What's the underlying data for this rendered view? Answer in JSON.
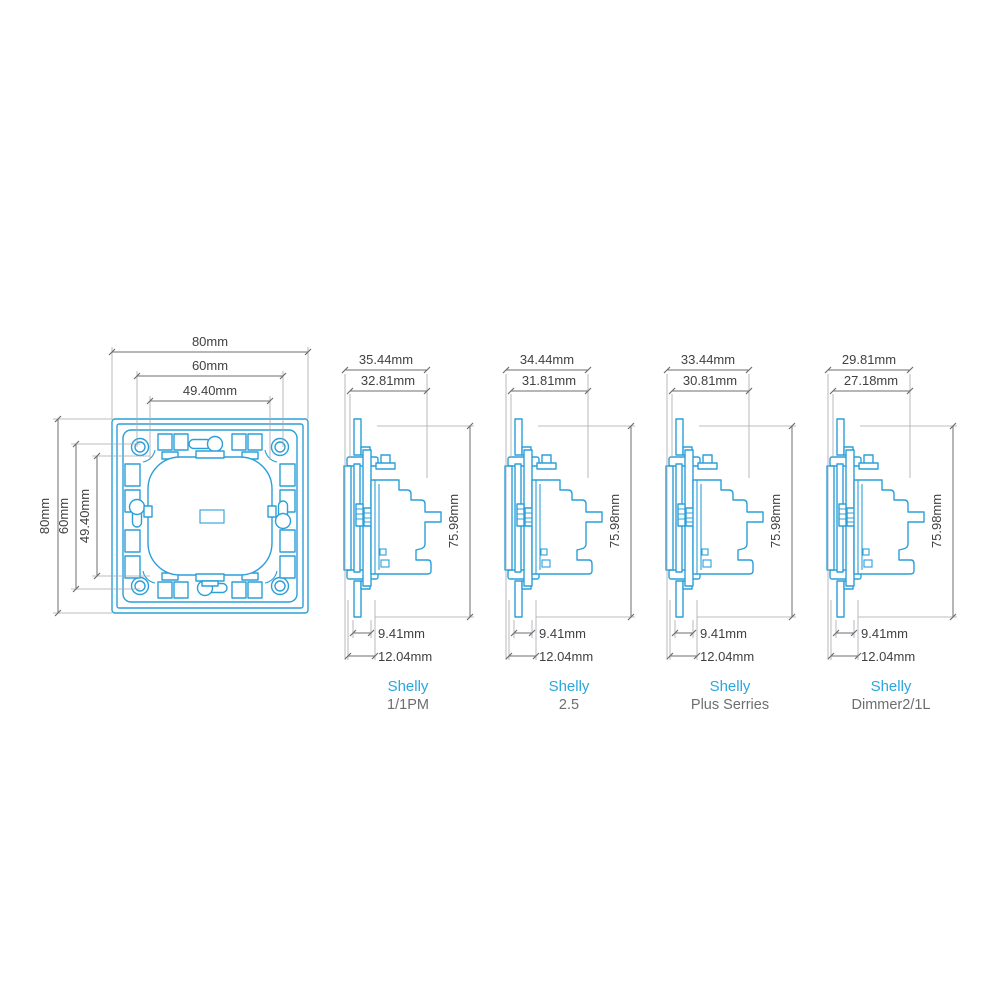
{
  "colors": {
    "device_line": "#2B9FD8",
    "brand_text": "#2AA7DF",
    "model_text": "#6D6E71",
    "dim_line": "#6D6E71",
    "dim_ext": "#A7A9AC",
    "dim_text": "#414042"
  },
  "front_view": {
    "top_dims": [
      {
        "label": "80mm"
      },
      {
        "label": "60mm"
      },
      {
        "label": "49.40mm"
      }
    ],
    "left_dims": [
      {
        "label": "80mm"
      },
      {
        "label": "60mm"
      },
      {
        "label": "49.40mm"
      }
    ]
  },
  "side_views": [
    {
      "brand": "Shelly",
      "model": "1/1PM",
      "depth_dim": "35.44mm",
      "inner_depth_dim": "32.81mm",
      "height_dim": "75.98mm",
      "front_depth_dim": "9.41mm",
      "plate_depth_dim": "12.04mm"
    },
    {
      "brand": "Shelly",
      "model": "2.5",
      "depth_dim": "34.44mm",
      "inner_depth_dim": "31.81mm",
      "height_dim": "75.98mm",
      "front_depth_dim": "9.41mm",
      "plate_depth_dim": "12.04mm"
    },
    {
      "brand": "Shelly",
      "model": "Plus Serries",
      "depth_dim": "33.44mm",
      "inner_depth_dim": "30.81mm",
      "height_dim": "75.98mm",
      "front_depth_dim": "9.41mm",
      "plate_depth_dim": "12.04mm"
    },
    {
      "brand": "Shelly",
      "model": "Dimmer2/1L",
      "depth_dim": "29.81mm",
      "inner_depth_dim": "27.18mm",
      "height_dim": "75.98mm",
      "front_depth_dim": "9.41mm",
      "plate_depth_dim": "12.04mm"
    }
  ]
}
